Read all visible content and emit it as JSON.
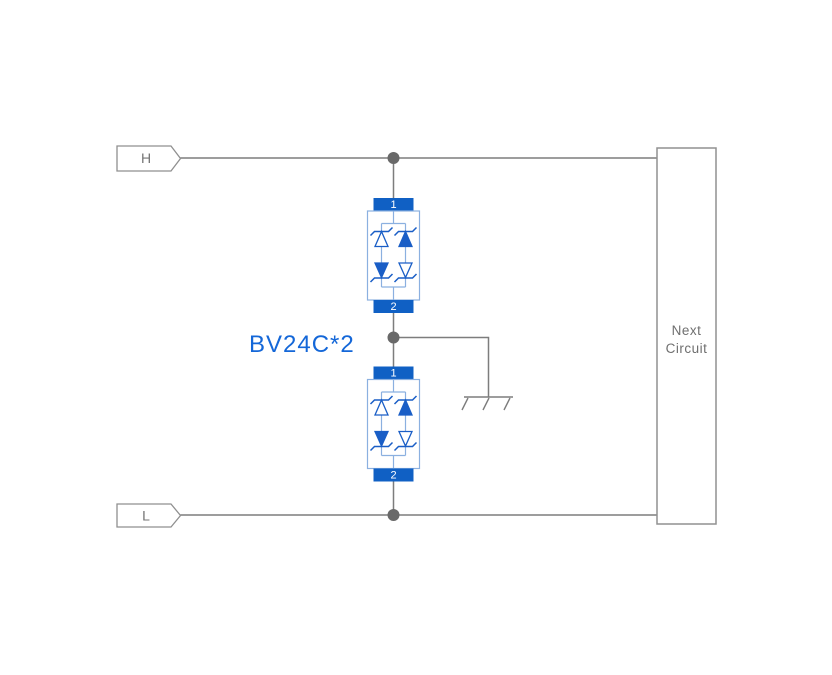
{
  "schematic": {
    "part_label": "BV24C*2",
    "terminals": {
      "h": "H",
      "l": "L"
    },
    "next_circuit": {
      "line1": "Next",
      "line2": "Circuit"
    },
    "components": [
      {
        "id": "tvs-1",
        "pin_top": "1",
        "pin_bottom": "2"
      },
      {
        "id": "tvs-2",
        "pin_top": "1",
        "pin_bottom": "2"
      }
    ],
    "colors": {
      "wire_gray": "#7d7d7d",
      "junction_gray": "#696969",
      "pin_block_blue": "#1060c4",
      "diode_blue": "#1a5ec6",
      "component_outline_blue": "#8bb0e0",
      "label_blue": "#1467d8",
      "box_text_gray": "#6f6f6f"
    },
    "icons": [
      "ground-icon",
      "terminal-flag-icon",
      "junction-dot-icon",
      "tvs-diode-array-icon"
    ]
  }
}
